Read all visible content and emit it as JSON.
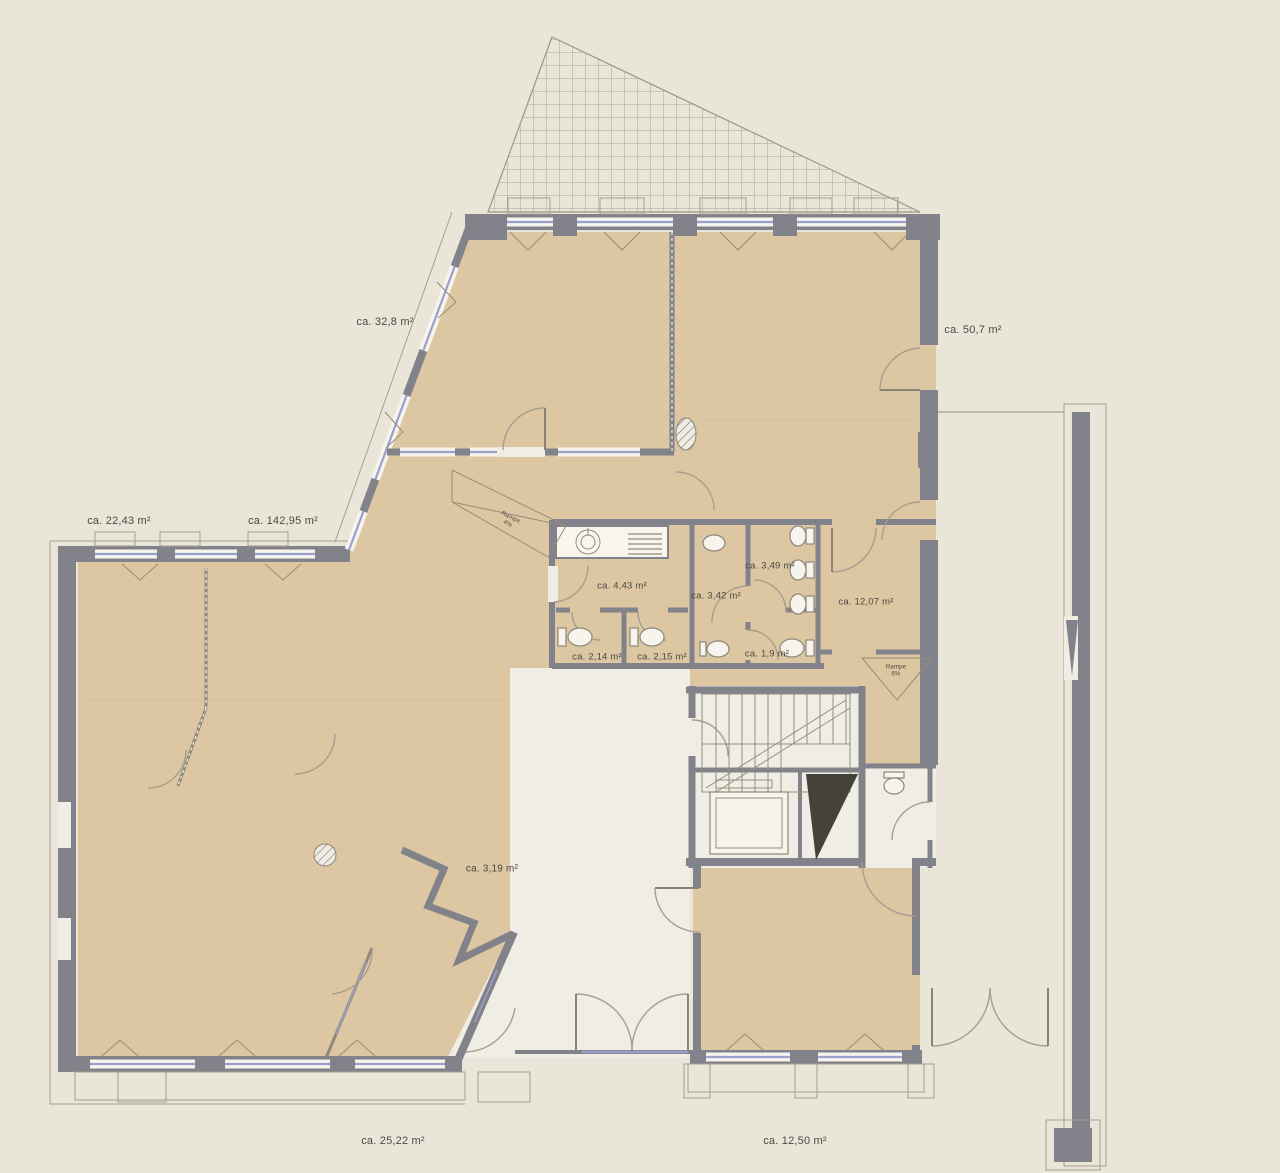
{
  "plan": {
    "rooms": [
      {
        "id": "top-left-room",
        "label": "ca. 32,8 m²"
      },
      {
        "id": "top-right-room",
        "label": "ca. 50,7 m²"
      },
      {
        "id": "left-side-room",
        "label": "ca. 22,43 m²"
      },
      {
        "id": "main-area",
        "label": "ca. 142,95 m²"
      },
      {
        "id": "wc-vestibule",
        "label": "ca. 4,43 m²"
      },
      {
        "id": "wc-middle-room",
        "label": "ca. 3,42 m²"
      },
      {
        "id": "wc-right-room",
        "label": "ca. 3,49 m²"
      },
      {
        "id": "side-room",
        "label": "ca. 12,07 m²"
      },
      {
        "id": "wc-stall-1",
        "label": "ca. 2,14 m²"
      },
      {
        "id": "wc-stall-2",
        "label": "ca. 2,15 m²"
      },
      {
        "id": "wc-small-room",
        "label": "ca. 1,9 m²"
      },
      {
        "id": "wall-niche",
        "label": "ca. 3,19 m²"
      },
      {
        "id": "bottom-left-room",
        "label": "ca. 25,22 m²"
      },
      {
        "id": "bottom-right-room",
        "label": "ca. 12,50 m²"
      }
    ],
    "ramps": [
      {
        "id": "ramp-interior",
        "line1": "Rampe",
        "line2": "4%"
      },
      {
        "id": "ramp-side",
        "line1": "Rampe",
        "line2": "6%"
      }
    ],
    "colors": {
      "background": "#e9e6d9",
      "room_fill": "#dcc7a2",
      "wall": "#82828a",
      "window_glass": "#9aa0cc",
      "interior_light": "#f0eee4",
      "label_text": "#4b4842"
    }
  }
}
